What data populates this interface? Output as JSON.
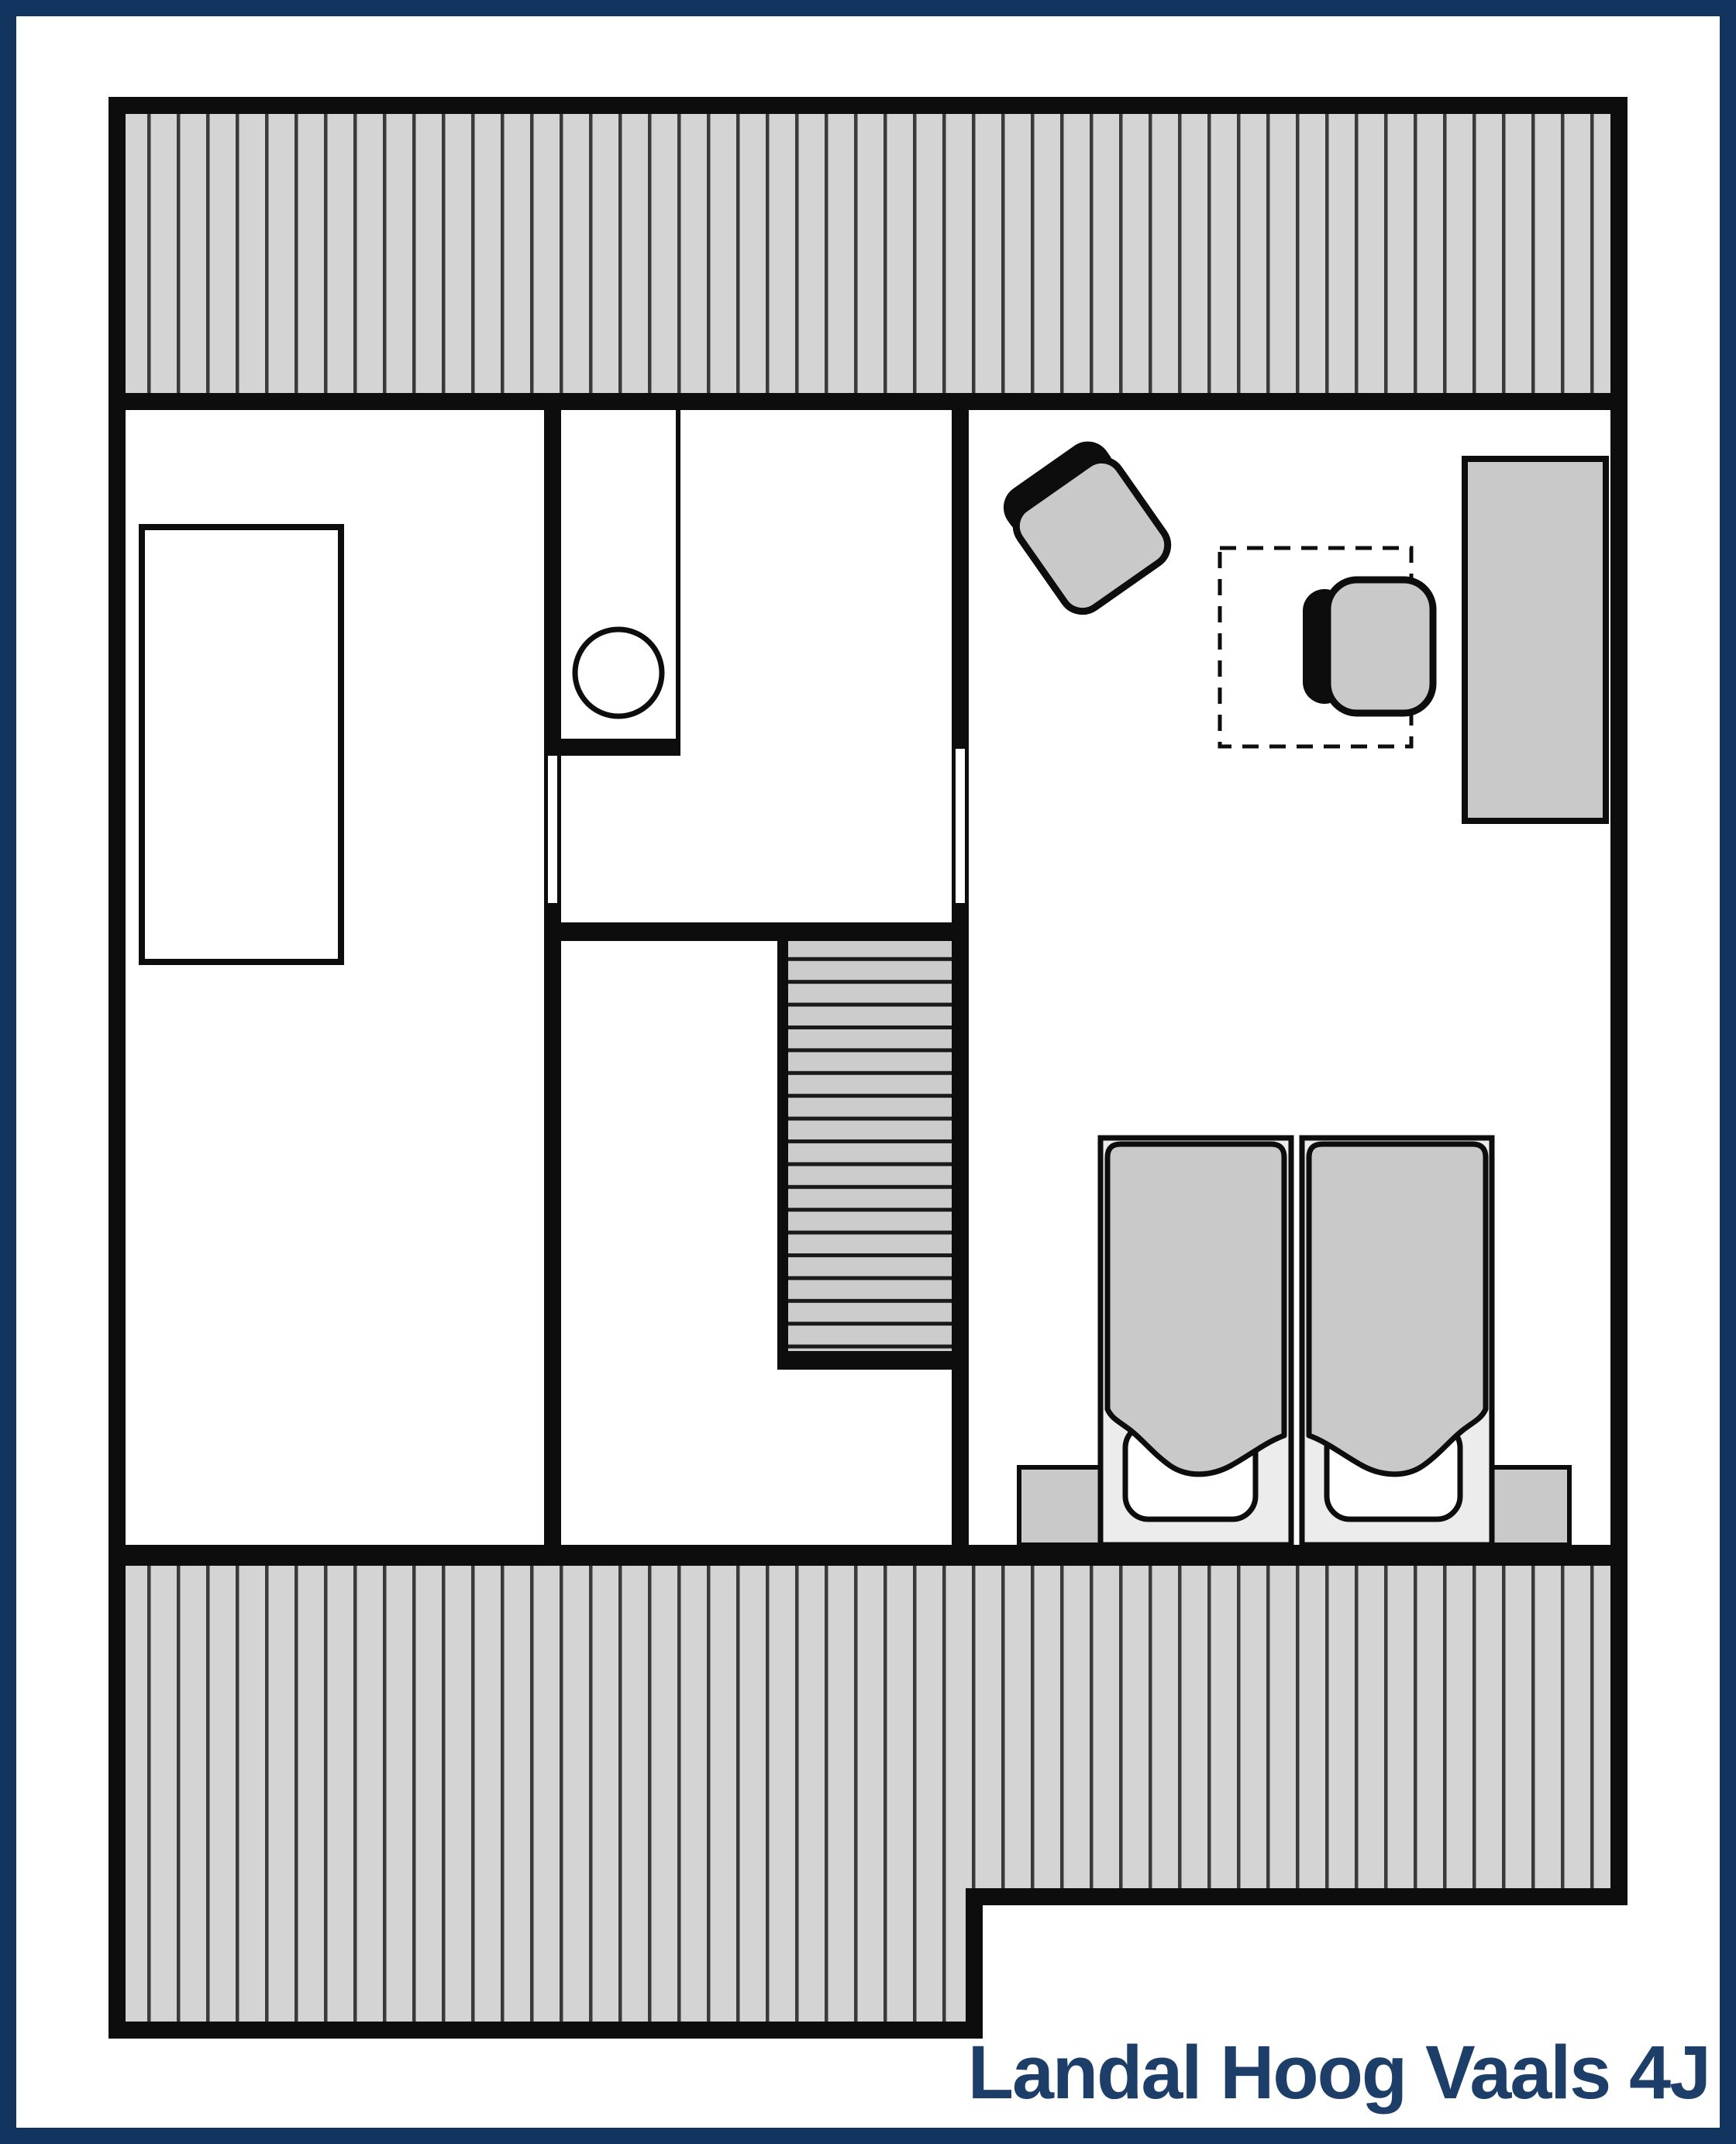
{
  "title": {
    "label": "Landal Hoog Vaals 4J"
  },
  "colors": {
    "frame": "#11355f",
    "title_text": "#1c3e68",
    "wall": "#0d0d0d",
    "hatch_fill": "#d4d4d4",
    "hatch_line": "#3a3a3a",
    "stairs_fill": "#cccccc",
    "stairs_line": "#1a1a1a",
    "furniture_fill": "#c9c9c9",
    "bed_frame_fill": "#ececec",
    "pillow_fill": "#ffffff",
    "background": "#ffffff"
  },
  "legend": {
    "floor": "upper floor plan",
    "items": [
      "roof-hatch",
      "bedroom-left",
      "wc",
      "stairs",
      "bedroom-right",
      "two-single-beds",
      "armchairs",
      "wardrobe"
    ]
  }
}
